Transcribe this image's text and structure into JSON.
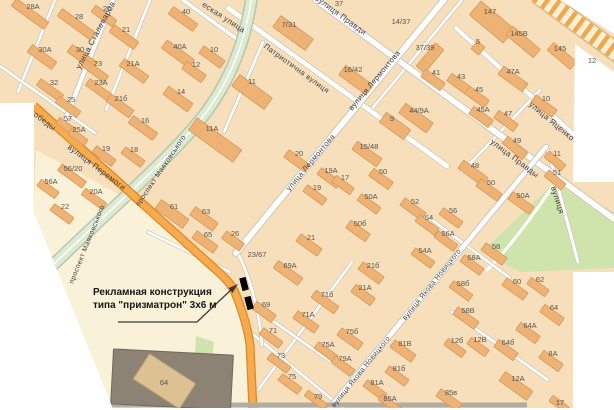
{
  "map": {
    "annotation": {
      "line1": "Рекламная конструкция",
      "line2": "типа \"призматрон\" 3х6 м"
    },
    "colors": {
      "land": "#f6dfba",
      "open": "#faf2d8",
      "building": "#eeb274",
      "building_stroke": "#d6985c",
      "dark_building": "#8d8375",
      "tan_building": "#dcc292",
      "road_casing": "#cfc8b8",
      "road_fill": "#ffffff",
      "avenue": "#dcead2",
      "avenue_casing": "#b7c6aa",
      "highway": "#f7aa4e",
      "highway_casing": "#d98a26",
      "park": "#cfe3ac",
      "railway_base": "#fdf0d2",
      "railway_stripe": "#f0a850",
      "railway_casing": "#d9bc84",
      "bottom_road": "#b3aca0",
      "marker": "#000000",
      "street_label": "#3f3f48",
      "number_label": "#59544c"
    },
    "street_labels": [
      {
        "t": "улица Сталеваров",
        "x": 95,
        "y": 35,
        "r": -62,
        "s": 8
      },
      {
        "t": "еская улица",
        "x": 224,
        "y": 17,
        "r": 33,
        "s": 8
      },
      {
        "t": "Патриотична вулиця",
        "x": 297,
        "y": 68,
        "r": 36,
        "s": 7.5
      },
      {
        "t": "вулиця Правди",
        "x": 341,
        "y": 15,
        "r": 36,
        "s": 8
      },
      {
        "t": "улица Правды",
        "x": 515,
        "y": 158,
        "r": 37,
        "s": 8
      },
      {
        "t": "вулиця Лермонтова",
        "x": 374,
        "y": 80,
        "r": -50,
        "s": 7.5
      },
      {
        "t": "улица Лермонтова",
        "x": 310,
        "y": 162,
        "r": -50,
        "s": 7.5
      },
      {
        "t": "вулиця Перемоги",
        "x": 97,
        "y": 167,
        "r": 37,
        "s": 8
      },
      {
        "t": "обеды",
        "x": 45,
        "y": 121,
        "r": 37,
        "s": 8
      },
      {
        "t": "проспект Маяковського",
        "x": 160,
        "y": 170,
        "r": -56,
        "s": 7
      },
      {
        "t": "проспект Маяковського",
        "x": 86,
        "y": 244,
        "r": -68,
        "s": 7
      },
      {
        "t": "вулиця Якова Новицкого",
        "x": 360,
        "y": 371,
        "r": -51,
        "s": 7
      },
      {
        "t": "вулиця Якова Новицкого",
        "x": 431,
        "y": 284,
        "r": -51,
        "s": 7
      },
      {
        "t": "улица Яценко",
        "x": 552,
        "y": 121,
        "r": 40,
        "s": 8
      },
      {
        "t": "вулиця",
        "x": 558,
        "y": 200,
        "r": 72,
        "s": 8
      }
    ],
    "building_labels": [
      {
        "t": "28А",
        "x": 33,
        "y": 6
      },
      {
        "t": "28",
        "x": 79,
        "y": 16
      },
      {
        "t": "26",
        "x": 107,
        "y": 8
      },
      {
        "t": "40",
        "x": 186,
        "y": 11
      },
      {
        "t": "30А",
        "x": 45,
        "y": 49
      },
      {
        "t": "30",
        "x": 80,
        "y": 49
      },
      {
        "t": "21",
        "x": 126,
        "y": 29
      },
      {
        "t": "40А",
        "x": 180,
        "y": 46
      },
      {
        "t": "23",
        "x": 98,
        "y": 63
      },
      {
        "t": "21А",
        "x": 133,
        "y": 63
      },
      {
        "t": "12",
        "x": 196,
        "y": 64
      },
      {
        "t": "32",
        "x": 54,
        "y": 82
      },
      {
        "t": "23А",
        "x": 101,
        "y": 82
      },
      {
        "t": "14",
        "x": 181,
        "y": 91
      },
      {
        "t": "25",
        "x": 71,
        "y": 99
      },
      {
        "t": "21б",
        "x": 121,
        "y": 98
      },
      {
        "t": "16",
        "x": 145,
        "y": 120
      },
      {
        "t": "57",
        "x": 68,
        "y": 118
      },
      {
        "t": "25А",
        "x": 79,
        "y": 129
      },
      {
        "t": "19",
        "x": 106,
        "y": 148
      },
      {
        "t": "18",
        "x": 134,
        "y": 149
      },
      {
        "t": "56/20",
        "x": 73,
        "y": 168
      },
      {
        "t": "56А",
        "x": 51,
        "y": 181
      },
      {
        "t": "20А",
        "x": 96,
        "y": 191
      },
      {
        "t": "22",
        "x": 65,
        "y": 206
      },
      {
        "t": "61",
        "x": 174,
        "y": 206
      },
      {
        "t": "63",
        "x": 206,
        "y": 211
      },
      {
        "t": "65",
        "x": 208,
        "y": 234
      },
      {
        "t": "26",
        "x": 235,
        "y": 233
      },
      {
        "t": "10",
        "x": 214,
        "y": 49
      },
      {
        "t": "11",
        "x": 252,
        "y": 81
      },
      {
        "t": "11А",
        "x": 212,
        "y": 128
      },
      {
        "t": "7/31",
        "x": 289,
        "y": 24
      },
      {
        "t": "37",
        "x": 339,
        "y": 3
      },
      {
        "t": "16/42",
        "x": 353,
        "y": 69
      },
      {
        "t": "14/37",
        "x": 401,
        "y": 21
      },
      {
        "t": "9",
        "x": 392,
        "y": 118
      },
      {
        "t": "147",
        "x": 490,
        "y": 11
      },
      {
        "t": "5",
        "x": 478,
        "y": 41
      },
      {
        "t": "145В",
        "x": 519,
        "y": 33
      },
      {
        "t": "145",
        "x": 560,
        "y": 48
      },
      {
        "t": "37/39",
        "x": 425,
        "y": 47
      },
      {
        "t": "41",
        "x": 436,
        "y": 72
      },
      {
        "t": "43",
        "x": 461,
        "y": 76
      },
      {
        "t": "45",
        "x": 479,
        "y": 89
      },
      {
        "t": "45А",
        "x": 483,
        "y": 109
      },
      {
        "t": "47",
        "x": 508,
        "y": 113
      },
      {
        "t": "47А",
        "x": 513,
        "y": 71
      },
      {
        "t": "44/9А",
        "x": 419,
        "y": 110
      },
      {
        "t": "10",
        "x": 546,
        "y": 98
      },
      {
        "t": "12",
        "x": 592,
        "y": 60
      },
      {
        "t": "20",
        "x": 299,
        "y": 153
      },
      {
        "t": "15/48",
        "x": 369,
        "y": 146
      },
      {
        "t": "19А",
        "x": 331,
        "y": 170
      },
      {
        "t": "17",
        "x": 345,
        "y": 177
      },
      {
        "t": "50",
        "x": 383,
        "y": 171
      },
      {
        "t": "19",
        "x": 317,
        "y": 187
      },
      {
        "t": "50А",
        "x": 371,
        "y": 196
      },
      {
        "t": "50б",
        "x": 360,
        "y": 223
      },
      {
        "t": "21",
        "x": 311,
        "y": 237
      },
      {
        "t": "23/67",
        "x": 257,
        "y": 254
      },
      {
        "t": "49",
        "x": 517,
        "y": 140
      },
      {
        "t": "11",
        "x": 557,
        "y": 153
      },
      {
        "t": "51",
        "x": 557,
        "y": 172
      },
      {
        "t": "48",
        "x": 475,
        "y": 165
      },
      {
        "t": "50",
        "x": 491,
        "y": 182
      },
      {
        "t": "50А",
        "x": 523,
        "y": 195
      },
      {
        "t": "52",
        "x": 415,
        "y": 201
      },
      {
        "t": "54",
        "x": 429,
        "y": 217
      },
      {
        "t": "56",
        "x": 453,
        "y": 210
      },
      {
        "t": "56А",
        "x": 448,
        "y": 233
      },
      {
        "t": "54А",
        "x": 425,
        "y": 250
      },
      {
        "t": "58",
        "x": 496,
        "y": 246
      },
      {
        "t": "58А",
        "x": 474,
        "y": 257
      },
      {
        "t": "69А",
        "x": 290,
        "y": 265
      },
      {
        "t": "21б",
        "x": 373,
        "y": 265
      },
      {
        "t": "21А",
        "x": 365,
        "y": 287
      },
      {
        "t": "71б",
        "x": 327,
        "y": 294
      },
      {
        "t": "69",
        "x": 266,
        "y": 304
      },
      {
        "t": "71А",
        "x": 308,
        "y": 314
      },
      {
        "t": "71",
        "x": 273,
        "y": 330
      },
      {
        "t": "75б",
        "x": 352,
        "y": 331
      },
      {
        "t": "75А",
        "x": 328,
        "y": 344
      },
      {
        "t": "73",
        "x": 281,
        "y": 355
      },
      {
        "t": "79А",
        "x": 345,
        "y": 358
      },
      {
        "t": "81В",
        "x": 405,
        "y": 343
      },
      {
        "t": "81б",
        "x": 399,
        "y": 368
      },
      {
        "t": "75",
        "x": 292,
        "y": 376
      },
      {
        "t": "81А",
        "x": 377,
        "y": 382
      },
      {
        "t": "79",
        "x": 318,
        "y": 396
      },
      {
        "t": "85А",
        "x": 390,
        "y": 398
      },
      {
        "t": "85в",
        "x": 451,
        "y": 392
      },
      {
        "t": "12А",
        "x": 518,
        "y": 378
      },
      {
        "t": "12б",
        "x": 457,
        "y": 340
      },
      {
        "t": "12В",
        "x": 480,
        "y": 339
      },
      {
        "t": "64б",
        "x": 508,
        "y": 342
      },
      {
        "t": "58В",
        "x": 468,
        "y": 310
      },
      {
        "t": "58б",
        "x": 463,
        "y": 283
      },
      {
        "t": "60",
        "x": 517,
        "y": 281
      },
      {
        "t": "62",
        "x": 540,
        "y": 279
      },
      {
        "t": "64",
        "x": 554,
        "y": 307
      },
      {
        "t": "64А",
        "x": 530,
        "y": 325
      },
      {
        "t": "8А",
        "x": 553,
        "y": 353
      },
      {
        "t": "17",
        "x": 560,
        "y": 402
      },
      {
        "t": "64",
        "x": 164,
        "y": 382
      }
    ],
    "buildings": [
      [
        30,
        14,
        40,
        9,
        36
      ],
      [
        76,
        24,
        40,
        9,
        36
      ],
      [
        104,
        16,
        26,
        8,
        36
      ],
      [
        183,
        19,
        30,
        9,
        36
      ],
      [
        42,
        57,
        30,
        9,
        36
      ],
      [
        82,
        57,
        30,
        9,
        36
      ],
      [
        124,
        37,
        30,
        9,
        36
      ],
      [
        178,
        54,
        34,
        10,
        36
      ],
      [
        95,
        71,
        28,
        8,
        36
      ],
      [
        134,
        71,
        30,
        9,
        36
      ],
      [
        194,
        72,
        24,
        9,
        36
      ],
      [
        50,
        90,
        28,
        8,
        36
      ],
      [
        99,
        90,
        28,
        8,
        36
      ],
      [
        178,
        99,
        30,
        10,
        36
      ],
      [
        68,
        107,
        26,
        8,
        36
      ],
      [
        120,
        106,
        28,
        9,
        36
      ],
      [
        143,
        128,
        30,
        9,
        36
      ],
      [
        66,
        126,
        20,
        7,
        36
      ],
      [
        78,
        137,
        20,
        7,
        36
      ],
      [
        104,
        156,
        24,
        8,
        36
      ],
      [
        133,
        157,
        24,
        8,
        36
      ],
      [
        72,
        176,
        30,
        8,
        36
      ],
      [
        48,
        189,
        22,
        8,
        36
      ],
      [
        94,
        199,
        26,
        8,
        36
      ],
      [
        62,
        214,
        24,
        8,
        36
      ],
      [
        172,
        214,
        34,
        11,
        36
      ],
      [
        204,
        219,
        28,
        10,
        36
      ],
      [
        205,
        242,
        26,
        9,
        36
      ],
      [
        233,
        241,
        22,
        9,
        36
      ],
      [
        212,
        57,
        26,
        9,
        36
      ],
      [
        252,
        92,
        14,
        40,
        -54
      ],
      [
        215,
        140,
        15,
        55,
        -54
      ],
      [
        293,
        33,
        40,
        14,
        36
      ],
      [
        356,
        80,
        12,
        34,
        -54
      ],
      [
        395,
        126,
        12,
        30,
        -54
      ],
      [
        492,
        22,
        44,
        18,
        40
      ],
      [
        523,
        42,
        36,
        11,
        40
      ],
      [
        562,
        56,
        30,
        10,
        40
      ],
      [
        478,
        48,
        10,
        10,
        40
      ],
      [
        430,
        58,
        30,
        11,
        -50
      ],
      [
        433,
        80,
        24,
        9,
        36
      ],
      [
        459,
        84,
        24,
        9,
        36
      ],
      [
        513,
        79,
        30,
        10,
        36
      ],
      [
        477,
        97,
        24,
        9,
        36
      ],
      [
        481,
        117,
        24,
        9,
        36
      ],
      [
        506,
        121,
        24,
        9,
        36
      ],
      [
        416,
        118,
        34,
        12,
        36
      ],
      [
        544,
        106,
        26,
        9,
        36
      ],
      [
        297,
        161,
        26,
        9,
        36
      ],
      [
        329,
        178,
        24,
        8,
        36
      ],
      [
        343,
        185,
        22,
        8,
        36
      ],
      [
        315,
        195,
        24,
        8,
        36
      ],
      [
        381,
        179,
        24,
        9,
        36
      ],
      [
        369,
        204,
        24,
        8,
        36
      ],
      [
        367,
        154,
        30,
        10,
        36
      ],
      [
        358,
        231,
        24,
        9,
        36
      ],
      [
        309,
        245,
        26,
        9,
        36
      ],
      [
        515,
        148,
        26,
        9,
        40
      ],
      [
        555,
        161,
        22,
        8,
        40
      ],
      [
        555,
        180,
        22,
        8,
        40
      ],
      [
        473,
        173,
        30,
        10,
        36
      ],
      [
        489,
        190,
        26,
        9,
        36
      ],
      [
        521,
        203,
        26,
        9,
        36
      ],
      [
        413,
        209,
        26,
        9,
        36
      ],
      [
        427,
        225,
        24,
        8,
        36
      ],
      [
        451,
        218,
        24,
        8,
        36
      ],
      [
        446,
        241,
        24,
        8,
        36
      ],
      [
        423,
        258,
        24,
        8,
        36
      ],
      [
        494,
        254,
        26,
        9,
        36
      ],
      [
        472,
        265,
        24,
        8,
        36
      ],
      [
        288,
        273,
        30,
        9,
        36
      ],
      [
        371,
        273,
        26,
        9,
        36
      ],
      [
        363,
        295,
        24,
        9,
        36
      ],
      [
        325,
        302,
        28,
        9,
        36
      ],
      [
        264,
        312,
        24,
        9,
        36
      ],
      [
        306,
        322,
        26,
        9,
        36
      ],
      [
        271,
        338,
        24,
        8,
        36
      ],
      [
        350,
        339,
        26,
        9,
        36
      ],
      [
        326,
        352,
        24,
        8,
        36
      ],
      [
        279,
        363,
        24,
        8,
        36
      ],
      [
        343,
        366,
        24,
        8,
        36
      ],
      [
        290,
        384,
        24,
        8,
        36
      ],
      [
        316,
        400,
        24,
        7,
        36
      ],
      [
        403,
        351,
        26,
        9,
        36
      ],
      [
        397,
        376,
        24,
        8,
        36
      ],
      [
        375,
        390,
        24,
        8,
        36
      ],
      [
        390,
        404,
        24,
        7,
        36
      ],
      [
        449,
        400,
        26,
        9,
        36
      ],
      [
        516,
        386,
        34,
        11,
        36
      ],
      [
        455,
        348,
        22,
        8,
        36
      ],
      [
        478,
        347,
        22,
        8,
        36
      ],
      [
        506,
        350,
        24,
        9,
        36
      ],
      [
        466,
        318,
        26,
        9,
        36
      ],
      [
        461,
        291,
        24,
        8,
        36
      ],
      [
        515,
        289,
        26,
        9,
        36
      ],
      [
        538,
        287,
        22,
        8,
        36
      ],
      [
        552,
        315,
        24,
        9,
        36
      ],
      [
        528,
        333,
        24,
        9,
        36
      ],
      [
        551,
        361,
        24,
        9,
        36
      ],
      [
        559,
        404,
        20,
        7,
        36
      ]
    ],
    "markers": [
      {
        "x": 244,
        "y": 284
      },
      {
        "x": 249,
        "y": 303
      }
    ]
  }
}
